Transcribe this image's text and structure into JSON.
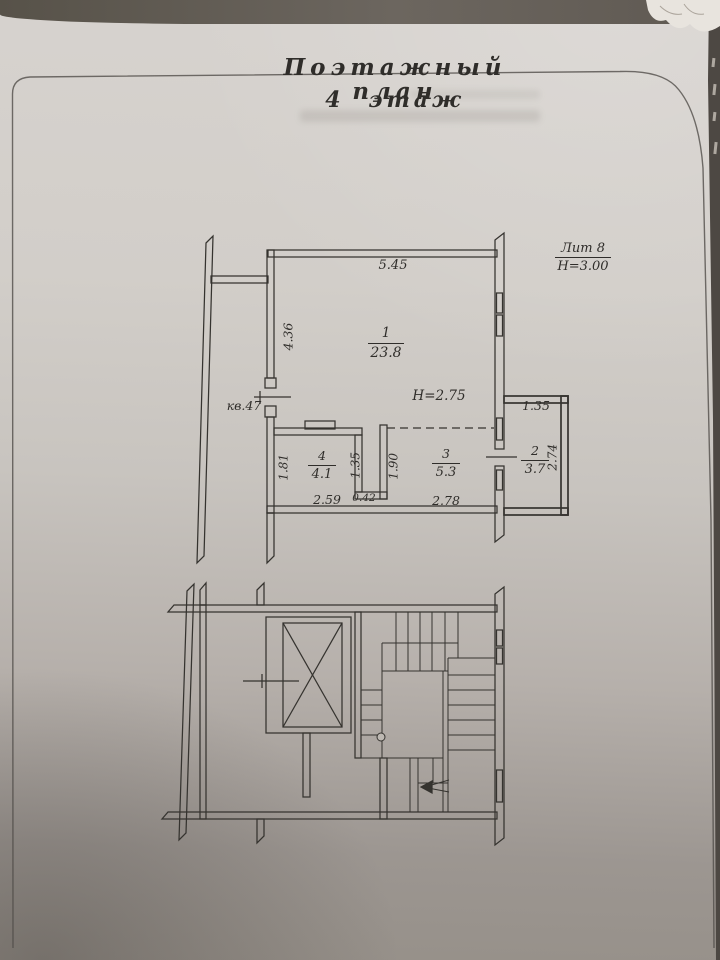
{
  "document": {
    "title_line1": "Поэтажный план",
    "title_line2": "4 этаж",
    "legend": {
      "liter": "Лит 8",
      "height_note": "Н=3.00"
    }
  },
  "floor_plan": {
    "apartment_label": "кв.47",
    "ceiling_height": "Н=2.75",
    "rooms": {
      "r1": {
        "num": "1",
        "area": "23.8"
      },
      "r2": {
        "num": "2",
        "area": "3.7"
      },
      "r3": {
        "num": "3",
        "area": "5.3"
      },
      "r4": {
        "num": "4",
        "area": "4.1"
      }
    },
    "dims": {
      "room1_width": "5.45",
      "room1_depth": "4.36",
      "room4_depth": "1.81",
      "room4_inner": "1.35",
      "room4_width": "2.59",
      "step": "0.42",
      "room3_depth": "1.90",
      "room3_width": "2.78",
      "room2_width": "1.35",
      "room2_depth": "2.74"
    }
  }
}
